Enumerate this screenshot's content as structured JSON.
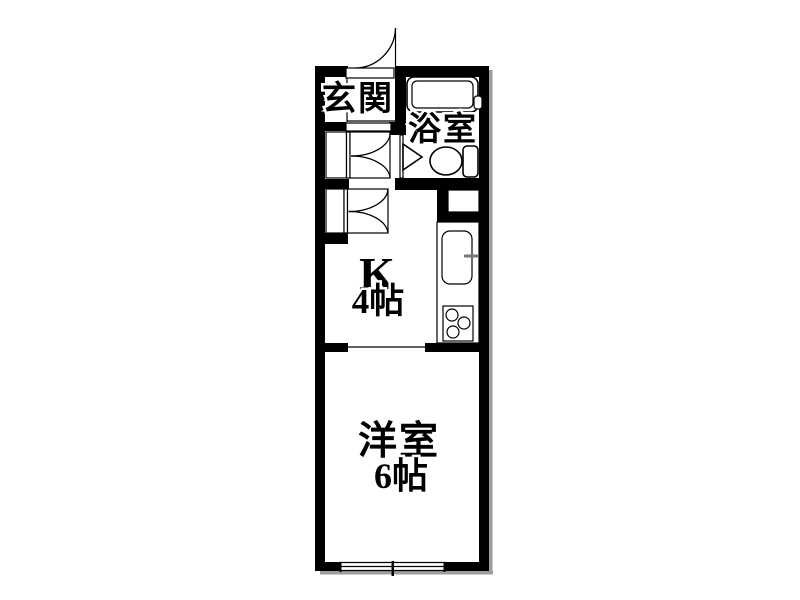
{
  "floorplan": {
    "type": "apartment-floor-plan",
    "background_color": "#ffffff",
    "wall_color": "#000000",
    "shadow_color": "#9e9e9e",
    "rooms": [
      {
        "id": "genkan",
        "label": "玄関"
      },
      {
        "id": "bathroom",
        "label": "浴室"
      },
      {
        "id": "kitchen",
        "label": "K",
        "size": "4帖"
      },
      {
        "id": "western-room",
        "label": "洋室",
        "size": "6帖"
      }
    ],
    "fixtures": [
      "entrance-swing-door",
      "bathtub",
      "toilet",
      "bathroom-folding-door",
      "closet-double-door-upper",
      "closet-double-door-lower",
      "pipe-space",
      "kitchen-sink",
      "faucet",
      "gas-stove-3-burners",
      "sliding-window",
      "room-opening"
    ]
  }
}
